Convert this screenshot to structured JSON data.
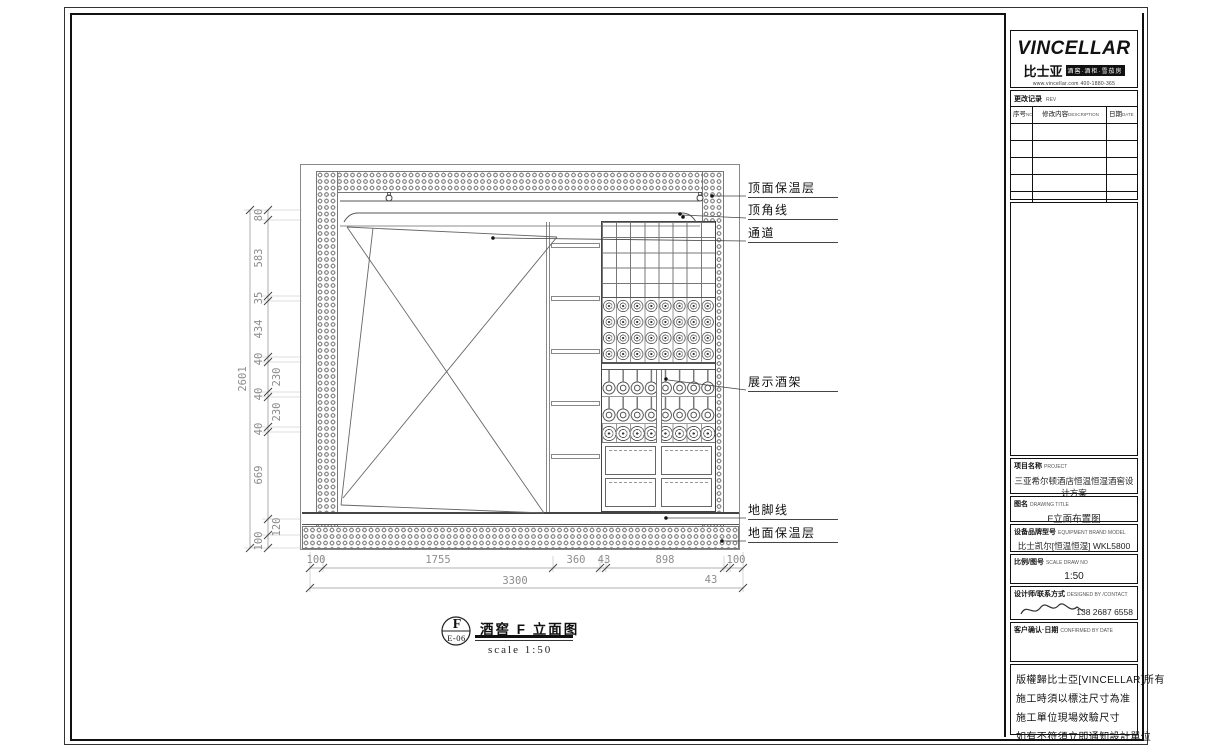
{
  "annotations": [
    "顶面保温层",
    "顶角线",
    "通道",
    "展示酒架",
    "地脚线",
    "地面保温层"
  ],
  "dims": {
    "left_chain": [
      "80",
      "583",
      "35",
      "434",
      "40",
      "230",
      "40",
      "230",
      "40",
      "669",
      "120",
      "100"
    ],
    "left_total": "2601",
    "bottom_chain": [
      "100",
      "1755",
      "360",
      "43",
      "898",
      "100"
    ],
    "bottom_extra": "43",
    "bottom_total": "3300"
  },
  "drawing_title": {
    "bubble_letter": "F",
    "bubble_code": "E-06",
    "title": "酒窖 F 立面图",
    "scale_text": "scale 1:50"
  },
  "title_block": {
    "logo": {
      "brand": "VINCELLAR",
      "brand_cn": "比士亚",
      "tagline": "酒窖·酒柜·雪茄房",
      "contact_line": "www.vincellar.com 400-1880-365"
    },
    "revision": {
      "title_cn": "更改记录",
      "title_en": "REV",
      "col_no_cn": "序号",
      "col_no_en": "NO",
      "col_desc_cn": "修改内容",
      "col_desc_en": "DESCRIPTION",
      "col_date_cn": "日期",
      "col_date_en": "DATE"
    },
    "project": {
      "label_cn": "项目名称",
      "label_en": "PROJECT",
      "value": "三亚希尔顿酒店恒温恒湿酒窖设计方案"
    },
    "drawing_name": {
      "label_cn": "图名",
      "label_en": "DRAWING TITLE",
      "value": "F立面布置图"
    },
    "equipment": {
      "label_cn": "设备品牌型号",
      "label_en": "EQUIPMENT BRAND MODEL",
      "value": "比士凯尔[恒温恒湿] WKL5800"
    },
    "scale_no": {
      "label_cn": "比例/图号",
      "label_en": "SCALE DRAW NO",
      "value": "1:50"
    },
    "designer": {
      "label_cn": "设计师/联系方式",
      "label_en": "DESIGNED BY /CONTACT",
      "phone": "138 2687 6558"
    },
    "confirm": {
      "label_cn": "客户确认·日期",
      "label_en": "CONFIRMED BY DATE"
    },
    "notes": [
      "版權歸比士亞[VINCELLAR]所有",
      "施工時須以標注尺寸為准",
      "施工單位現場效驗尺寸",
      "如有不符須立即通知設計單位"
    ]
  }
}
